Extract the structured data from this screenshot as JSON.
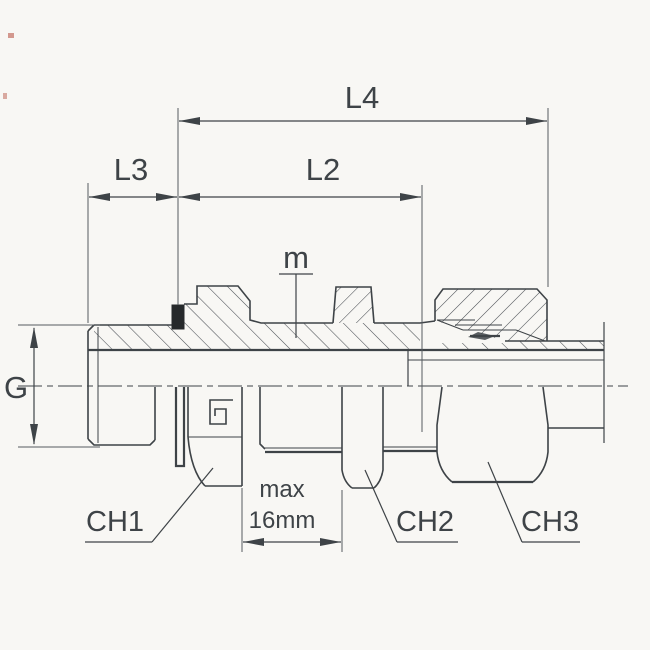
{
  "drawing": {
    "labels": {
      "l4": "L4",
      "l3": "L3",
      "l2": "L2",
      "m": "m",
      "g": "G",
      "ch1": "CH1",
      "ch2": "CH2",
      "ch3": "CH3",
      "max_line1": "max",
      "max_line2": "16mm"
    },
    "colors": {
      "line": "#3e4347",
      "hatch": "#4a4f54",
      "background": "#f8f7f4",
      "seal": "#26292b"
    }
  }
}
